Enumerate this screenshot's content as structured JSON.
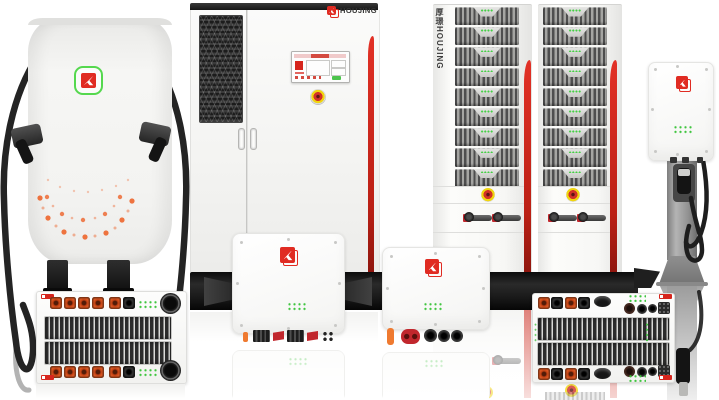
{
  "brand": {
    "name": "HOUJING",
    "name_vertical": "厚璟HOUJING"
  },
  "racks": {
    "module_rows": 9
  },
  "palette": {
    "brand_red": "#d6251d",
    "stripe_red": "#cf2318",
    "led_green": "#43cf43",
    "connector_orange": "#e65a22",
    "estop_yellow": "#f1d50e",
    "cable_black": "#242424",
    "pedestal_gray": "#9a9a9a",
    "background": "#ffffff"
  },
  "icons": {
    "brand_logo": "red-square-cursor-arrow",
    "emergency_stop": "yellow-ring-red-button",
    "cooling_fan": "black-round-fan",
    "vent": "chevron-ventilation-grille"
  }
}
